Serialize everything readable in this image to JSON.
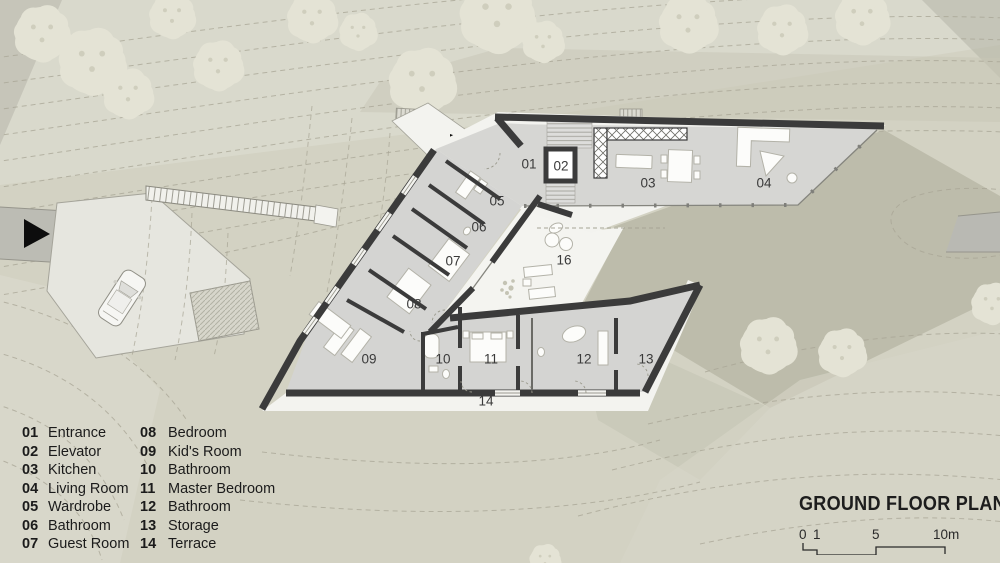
{
  "title_block": {
    "title": "GROUND FLOOR PLAN",
    "scale_labels": [
      "0",
      "1",
      "5",
      "10m"
    ]
  },
  "legend": {
    "columns": [
      [
        {
          "num": "01",
          "label": "Entrance"
        },
        {
          "num": "02",
          "label": "Elevator"
        },
        {
          "num": "03",
          "label": "Kitchen"
        },
        {
          "num": "04",
          "label": "Living Room"
        },
        {
          "num": "05",
          "label": "Wardrobe"
        },
        {
          "num": "06",
          "label": "Bathroom"
        },
        {
          "num": "07",
          "label": "Guest Room"
        }
      ],
      [
        {
          "num": "08",
          "label": "Bedroom"
        },
        {
          "num": "09",
          "label": "Kid's Room"
        },
        {
          "num": "10",
          "label": "Bathroom"
        },
        {
          "num": "11",
          "label": "Master Bedroom"
        },
        {
          "num": "12",
          "label": "Bathroom"
        },
        {
          "num": "13",
          "label": "Storage"
        },
        {
          "num": "14",
          "label": "Terrace"
        }
      ]
    ]
  },
  "plan": {
    "room_labels": [
      {
        "num": "01",
        "x": 529,
        "y": 164
      },
      {
        "num": "02",
        "x": 561,
        "y": 166
      },
      {
        "num": "03",
        "x": 648,
        "y": 183
      },
      {
        "num": "04",
        "x": 764,
        "y": 183
      },
      {
        "num": "05",
        "x": 497,
        "y": 201
      },
      {
        "num": "06",
        "x": 479,
        "y": 227
      },
      {
        "num": "07",
        "x": 453,
        "y": 261
      },
      {
        "num": "08",
        "x": 414,
        "y": 304
      },
      {
        "num": "09",
        "x": 369,
        "y": 359
      },
      {
        "num": "10",
        "x": 443,
        "y": 359
      },
      {
        "num": "11",
        "x": 491,
        "y": 359
      },
      {
        "num": "12",
        "x": 584,
        "y": 359
      },
      {
        "num": "13",
        "x": 646,
        "y": 359
      },
      {
        "num": "14",
        "x": 486,
        "y": 401
      },
      {
        "num": "16",
        "x": 564,
        "y": 260
      }
    ],
    "icons": [
      "road-arrow",
      "entrance-arrow"
    ]
  },
  "colors": {
    "background": "#d3d2c3",
    "wall": "#3b3b3b",
    "floor": "#d6d6d3",
    "terrace_white": "#f3f3ef",
    "contour": "#a8a595",
    "tree": "#e4e3d5",
    "road": "#bcbcb4",
    "arrow_black": "#0d0d0d"
  }
}
